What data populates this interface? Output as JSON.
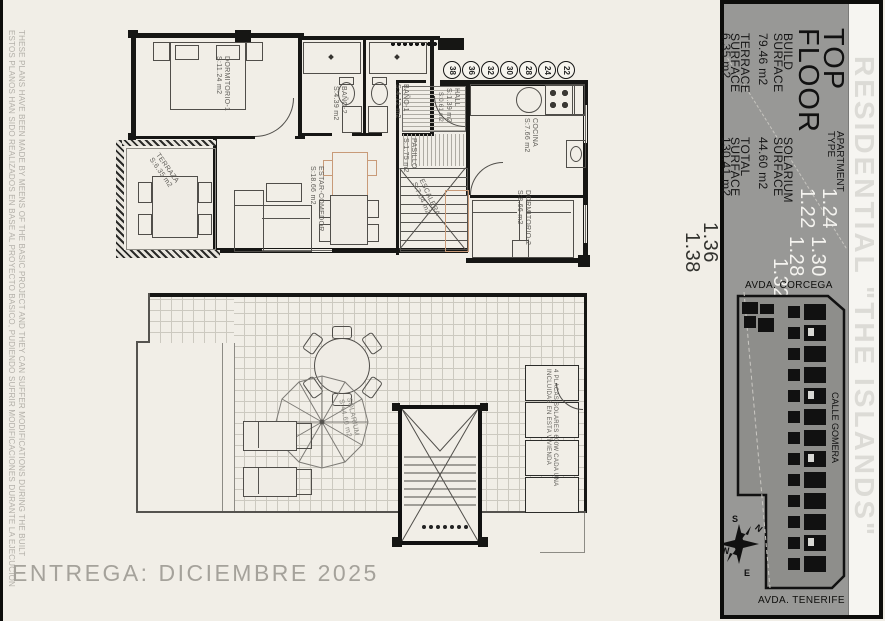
{
  "page": {
    "delivery_note": "ENTREGA: DICIEMBRE 2025"
  },
  "disclaimer": {
    "line_en": "THESE PLANS HAVE BEEN MADE BY MEENS OF THE BASIC PROJECT AND THEY CAN SUFFER MODIFICATIONS DURING THE BUILT",
    "line_es": "ESTOS PLANOS HAN SIDO REALIZADOS EN BASE AL PROYECTO BASICO, PUDIENDO SUFRIR MODIFICACIONES DURANTE LA EJECUCION"
  },
  "sidebar": {
    "floor_title_line1": "TOP",
    "floor_title_line2": "FLOOR",
    "apartment_type_label_line1": "APARTMENT",
    "apartment_type_label_line2": "TYPE",
    "apartment_types": [
      "1.22",
      "1.24",
      "1.28",
      "1.30",
      "1.32",
      "1.36",
      "1.38"
    ],
    "surfaces": [
      {
        "l1": "BUILD",
        "l2": "SURFACE",
        "value": "79.46 m2"
      },
      {
        "l1": "SOLARIUM",
        "l2": "SURFACE",
        "value": "44.60 m2"
      },
      {
        "l1": "TERRACE",
        "l2": "SURFACE",
        "value": "6.35 m2"
      },
      {
        "l1": "TOTAL",
        "l2": "SURFACE",
        "value": "130.41 m2"
      }
    ],
    "residential_title": "RESIDENTIAL \"THE ISLANDS\"",
    "site_plan": {
      "street_top": "AVDA. CORCEGA",
      "street_side": "CALLE GOMERA",
      "street_bottom": "AVDA. TENERIFE",
      "compass_n": "N",
      "compass_s": "S",
      "compass_e": "E",
      "compass_w": "W"
    }
  },
  "floor_plan": {
    "rooms": [
      {
        "name": "DORMITORIO-1",
        "area": "S:11.24 m2"
      },
      {
        "name": "BAÑO-2",
        "area": "S:4.39 m2"
      },
      {
        "name": "BAÑO-1",
        "area": "S:4.12 m2"
      },
      {
        "name": "HALL",
        "area": "S:1.39 m2"
      },
      {
        "name": "PASILLO",
        "area": "S:1.75 m2"
      },
      {
        "name": "COCINA",
        "area": "S:7.66 m2"
      },
      {
        "name": "DORMITORIO-2",
        "area": "S:8.66 m2"
      },
      {
        "name": "ESTAR-COMEDOR",
        "area": "S:18.66 m2"
      },
      {
        "name": "TERRAZA",
        "area": "S:6.35 m2"
      },
      {
        "name": "ESCALERA",
        "area": "S:7.04 m2"
      }
    ],
    "small_area_label": "S:0.61 m2",
    "unit_numbers": [
      "38",
      "36",
      "32",
      "30",
      "28",
      "24",
      "22"
    ]
  },
  "roof_plan": {
    "solarium_name": "SOLARIUM",
    "solarium_area": "S:44.60 m2",
    "solar_note_line1": "4 PLACAS SOLARES 600W CADA UNA",
    "solar_note_line2": "INCLUIDAS EN ESTA VIVIENDA"
  }
}
